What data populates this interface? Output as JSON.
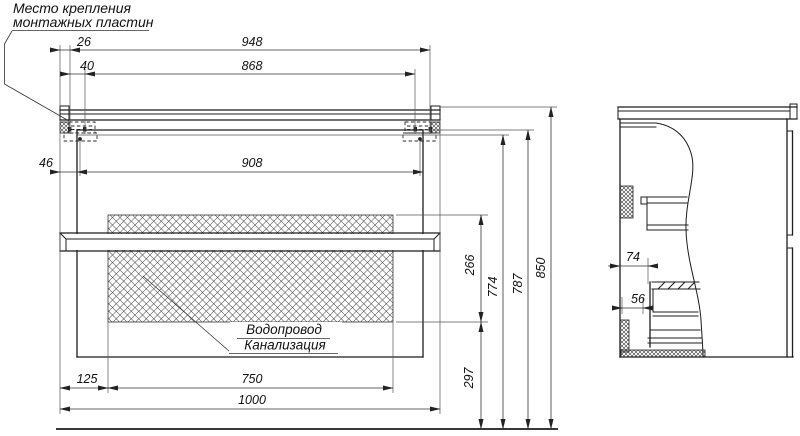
{
  "drawing": {
    "type": "technical-dimension-drawing",
    "line_color": "#1c1c1c",
    "background": "#ffffff"
  },
  "callout": {
    "line1": "Место крепления",
    "line2": "монтажных пластин"
  },
  "zone_label": {
    "line1": "Водопровод",
    "line2": "Канализация"
  },
  "dimensions": {
    "d26": "26",
    "d948": "948",
    "d40": "40",
    "d868": "868",
    "d46": "46",
    "d908": "908",
    "d266": "266",
    "d774": "774",
    "d787": "787",
    "d850": "850",
    "d125": "125",
    "d750": "750",
    "d1000": "1000",
    "d297": "297",
    "d74": "74",
    "d56": "56"
  }
}
